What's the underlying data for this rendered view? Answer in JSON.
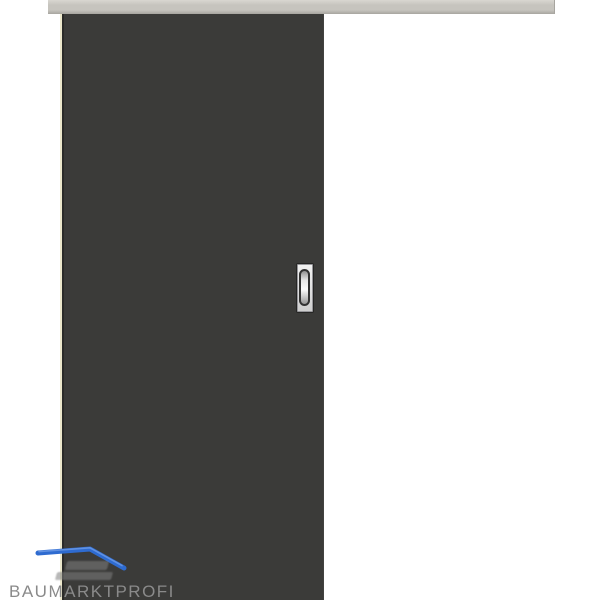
{
  "watermark": {
    "brand_text": "BAUMARKTPROFI"
  },
  "colors": {
    "background": "#ffffff",
    "rail_top": "#d9d7d1",
    "rail_mid": "#c6c4be",
    "rail_bottom": "#a7a59f",
    "door": "#3b3b39",
    "door_edge_light": "#ece8cc",
    "door_edge_dark": "#2b2b29",
    "handle_plate_light": "#f1f1f1",
    "handle_plate_dark": "#cfcfcf",
    "handle_recess_border": "#333333",
    "brand_blue": "#2e6bd0",
    "brand_blue_light": "#6d9be6",
    "watermark_gray": "#8a8a8a"
  }
}
